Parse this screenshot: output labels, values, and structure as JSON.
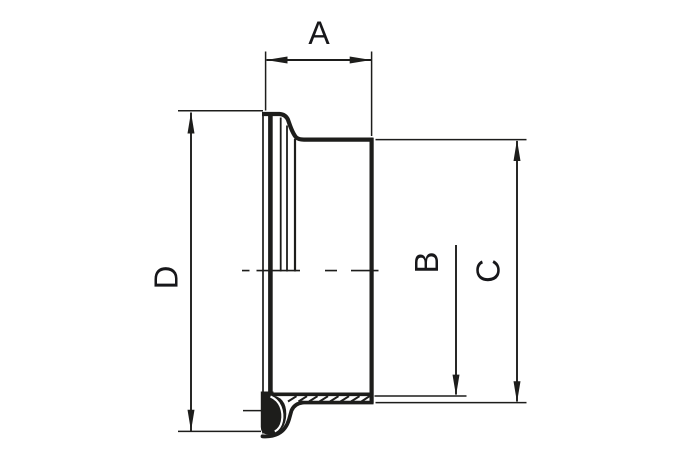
{
  "dimensions": {
    "a": {
      "label": "A"
    },
    "b": {
      "label": "B"
    },
    "c": {
      "label": "C"
    },
    "d": {
      "label": "D"
    }
  },
  "colors": {
    "line": "#1d1d1b",
    "text": "#17171a",
    "background": "#ffffff"
  }
}
